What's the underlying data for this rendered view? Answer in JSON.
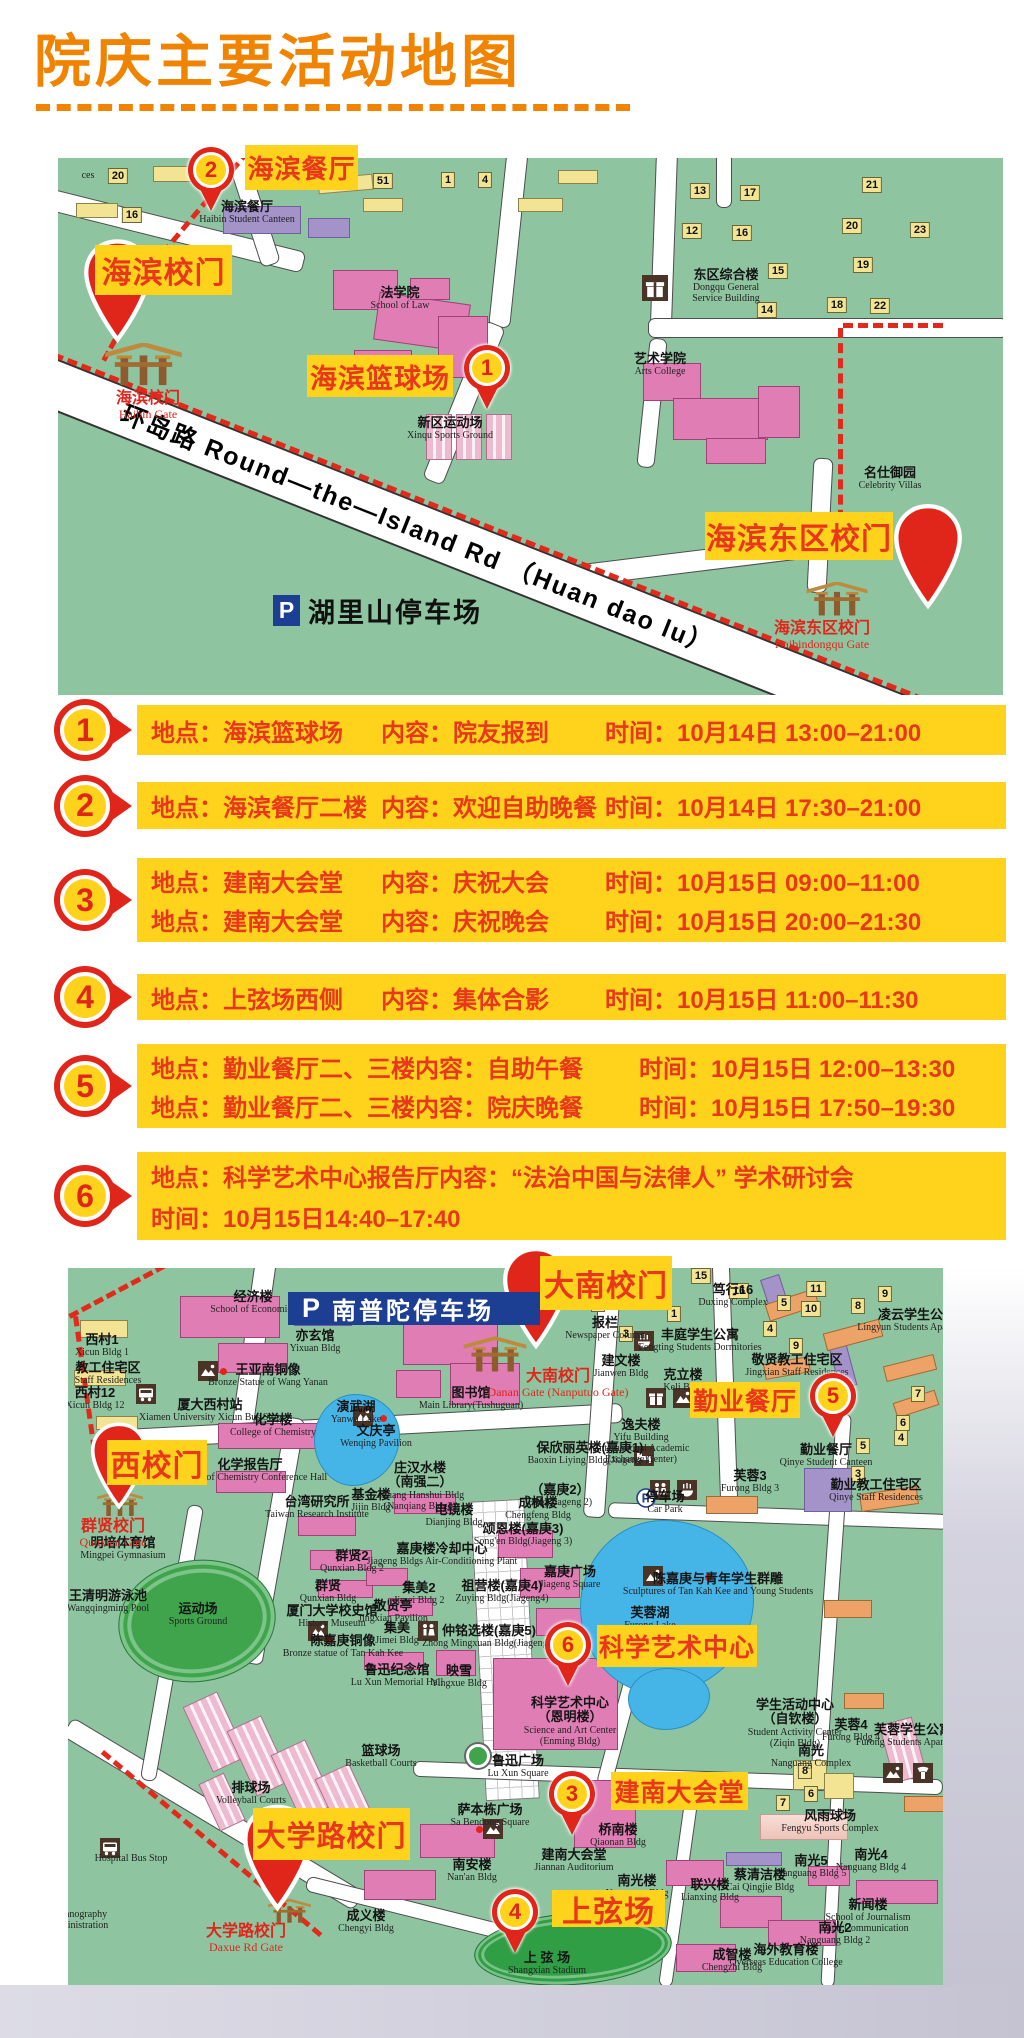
{
  "title": {
    "text": "院庆主要活动地图"
  },
  "colors": {
    "accent_orange": "#f08300",
    "tag_yellow": "#ffd31c",
    "text_red": "#e8371a",
    "pin_red": "#e0251b",
    "map_green": "#8ec5a0",
    "banner_blue": "#1c3f94",
    "lake_blue": "#45b5e8"
  },
  "top_map": {
    "road_label": "环岛路 Round—the—Island Rd （Huan dao lu）",
    "parking": {
      "p": "P",
      "text": "湖里山停车场",
      "x": 215,
      "y": 433
    },
    "tags": [
      [
        "海滨餐厅",
        187,
        -13,
        113,
        45
      ],
      [
        "海滨校门",
        37,
        87,
        137,
        50
      ],
      [
        "海滨篮球场",
        249,
        197,
        146,
        42
      ],
      [
        "海滨东区校门",
        647,
        354,
        188,
        48
      ]
    ],
    "markers": [
      [
        "2",
        153,
        12
      ],
      [
        "1",
        429,
        210
      ]
    ],
    "bigpins": [
      [
        25,
        74,
        69,
        118
      ],
      [
        835,
        335,
        70,
        127
      ]
    ],
    "gates": [
      {
        "ix": 44,
        "iy": 185,
        "iw": 83,
        "ih": 44,
        "x": 90,
        "y": 232,
        "zh": "海滨校门",
        "en": "Haibin Gate"
      },
      {
        "ix": 743,
        "iy": 424,
        "iw": 72,
        "ih": 35,
        "x": 764,
        "y": 462,
        "zh": "海滨东区校门",
        "en": "Haibindongqu Gate"
      }
    ],
    "labels": [
      [
        189,
        42,
        "海滨餐厅",
        "Haibin Student Canteen",
        ""
      ],
      [
        342,
        128,
        "法学院",
        "School of Law",
        ""
      ],
      [
        392,
        258,
        "新区运动场",
        "Xinqu Sports Ground",
        ""
      ],
      [
        602,
        194,
        "艺术学院",
        "Arts College",
        ""
      ],
      [
        668,
        110,
        "东区综合楼",
        "Dongqu General|Service Building",
        ""
      ],
      [
        832,
        308,
        "名仕御园",
        "Celebrity Villas",
        ""
      ],
      [
        30,
        12,
        "",
        "ces",
        ""
      ]
    ],
    "chips": [
      [
        "20",
        60,
        10
      ],
      [
        "16",
        74,
        49
      ],
      [
        "51",
        325,
        15
      ],
      [
        "1",
        390,
        14
      ],
      [
        "4",
        427,
        14
      ],
      [
        "13",
        642,
        25
      ],
      [
        "17",
        692,
        27
      ],
      [
        "21",
        814,
        19
      ],
      [
        "12",
        634,
        65
      ],
      [
        "16",
        684,
        67
      ],
      [
        "20",
        794,
        60
      ],
      [
        "23",
        862,
        64
      ],
      [
        "15",
        720,
        105
      ],
      [
        "19",
        805,
        99
      ],
      [
        "14",
        709,
        144
      ],
      [
        "18",
        779,
        139
      ],
      [
        "22",
        822,
        140
      ]
    ],
    "icons": [
      [
        "gift",
        584,
        117,
        26
      ]
    ],
    "dots": []
  },
  "events": {
    "field_labels": {
      "place": "地点",
      "content": "内容",
      "time": "时间"
    },
    "items": [
      {
        "num": "1",
        "y": 705,
        "h": 50,
        "rows": [
          {
            "p": "海滨篮球场",
            "c": "院友报到",
            "t": "10月14日 13:00–21:00"
          }
        ]
      },
      {
        "num": "2",
        "y": 782,
        "h": 47,
        "rows": [
          {
            "p": "海滨餐厅二楼",
            "c": "欢迎自助晚餐",
            "t": "10月14日 17:30–21:00"
          }
        ]
      },
      {
        "num": "3",
        "y": 858,
        "h": 84,
        "rows": [
          {
            "p": "建南大会堂",
            "c": "庆祝大会",
            "t": "10月15日 09:00–11:00"
          },
          {
            "p": "建南大会堂",
            "c": "庆祝晚会",
            "t": "10月15日 20:00–21:30"
          }
        ]
      },
      {
        "num": "4",
        "y": 974,
        "h": 46,
        "rows": [
          {
            "p": "上弦场西侧",
            "c": "集体合影",
            "t": "10月15日 11:00–11:30"
          }
        ]
      },
      {
        "num": "5",
        "y": 1044,
        "h": 84,
        "rows": [
          {
            "p": "勤业餐厅二、三楼",
            "c": "自助午餐",
            "t": "10月15日 12:00–13:30"
          },
          {
            "p": "勤业餐厅二、三楼",
            "c": "院庆晚餐",
            "t": "10月15日 17:50–19:30"
          }
        ]
      },
      {
        "num": "6",
        "y": 1152,
        "h": 88,
        "rows": [
          {
            "p": "科学艺术中心报告厅",
            "c": "“法治中国与法律人” 学术研讨会",
            "t": null
          },
          {
            "p": null,
            "c": null,
            "t": "10月15日14:40–17:40"
          }
        ]
      }
    ]
  },
  "bottom_map": {
    "banner": {
      "p": "P",
      "text": "南普陀停车场",
      "x": 220,
      "y": 24,
      "w": 252,
      "h": 33
    },
    "tags": [
      [
        "大南校门",
        472,
        -12,
        132,
        54
      ],
      [
        "西校门",
        39,
        172,
        100,
        45
      ],
      [
        "勤业餐厅",
        622,
        114,
        110,
        36
      ],
      [
        "科学艺术中心",
        529,
        357,
        160,
        42
      ],
      [
        "建南大会堂",
        543,
        504,
        137,
        38
      ],
      [
        "上弦场",
        484,
        622,
        113,
        37
      ],
      [
        "大学路校门",
        185,
        540,
        157,
        52
      ]
    ],
    "markers": [
      [
        "5",
        765,
        128
      ],
      [
        "6",
        500,
        377
      ],
      [
        "3",
        504,
        526
      ],
      [
        "4",
        447,
        644
      ]
    ],
    "bigpins": [
      [
        434,
        -25,
        68,
        110
      ],
      [
        22,
        148,
        58,
        100
      ],
      [
        174,
        529,
        71,
        122
      ]
    ],
    "gates": [
      {
        "ix": 394,
        "iy": 67,
        "iw": 66,
        "ih": 40,
        "x": 490,
        "y": 100,
        "zh": "大南校门",
        "en": "Danan Gate (Nanputuo Gate)"
      },
      {
        "ix": 28,
        "iy": 222,
        "iw": 48,
        "ih": 28,
        "x": 45,
        "y": 250,
        "zh": "群贤校门",
        "en": "Qunxian Gate"
      },
      {
        "ix": 199,
        "iy": 630,
        "iw": 45,
        "ih": 27,
        "x": 178,
        "y": 655,
        "zh": "大学路校门",
        "en": "Daxue Rd Gate"
      }
    ],
    "labels": [
      [
        185,
        22,
        "经济楼",
        "School of Economics",
        ""
      ],
      [
        247,
        61,
        "亦玄馆",
        "Yixuan Bldg",
        ""
      ],
      [
        200,
        95,
        "王亚南铜像",
        "Bronze Statue of Wang Yanan",
        ""
      ],
      [
        142,
        130,
        "厦大西村站",
        "Xiamen University Xicun Bus Stop",
        ""
      ],
      [
        205,
        145,
        "化学楼",
        "College of Chemistry",
        ""
      ],
      [
        288,
        132,
        "演武湖",
        "Yanwu Lake",
        ""
      ],
      [
        308,
        156,
        "文庆亭",
        "Wenqing Pavilion",
        ""
      ],
      [
        403,
        118,
        "图书馆",
        "Main Library(Tushuguan)",
        ""
      ],
      [
        182,
        190,
        "化学报告厅",
        "College of Chemistry Conference Hall",
        ""
      ],
      [
        352,
        193,
        "庄汉水楼|（南强二）",
        "Zhuang Hanshui Bldg|(Nanqiang Bldg2)",
        ""
      ],
      [
        249,
        227,
        "台湾研究所",
        "Taiwan Research Institute",
        ""
      ],
      [
        303,
        220,
        "基金楼",
        "Jijin Bldg",
        ""
      ],
      [
        386,
        235,
        "电镜楼",
        "Dianjing Bldg",
        ""
      ],
      [
        34,
        65,
        "西村1",
        "Xicun Bldg 1",
        ""
      ],
      [
        40,
        93,
        "教工住宅区",
        "Staff Residences",
        ""
      ],
      [
        27,
        118,
        "西村12",
        "Xicun Bldg 12",
        ""
      ],
      [
        522,
        173,
        "保欣丽英楼(嘉庚1)",
        "Baoxin Liying Bldg(Jiageng 1)",
        ""
      ],
      [
        492,
        215,
        "（嘉庚2）",
        "Bldg(Jiageng 2)",
        ""
      ],
      [
        470,
        228,
        "成枫楼",
        "Chengfeng Bldg",
        ""
      ],
      [
        455,
        254,
        "颂恩楼(嘉庚3)",
        "Song'en Bldg(Jiageng 3)",
        ""
      ],
      [
        374,
        274,
        "嘉庚楼冷却中心",
        "Jiageng Bldgs Air-Conditioning Plant",
        ""
      ],
      [
        434,
        311,
        "祖营楼(嘉庚4)",
        "Zuying Bldg(Jiageng4)",
        ""
      ],
      [
        502,
        297,
        "嘉庚广场",
        "Jiageng Square",
        ""
      ],
      [
        597,
        222,
        "停车场",
        "Car Park",
        ""
      ],
      [
        650,
        304,
        "陈嘉庚与青年学生群雕",
        "Sculptures of Tan Kah Kee and Young Students",
        ""
      ],
      [
        582,
        338,
        "芙蓉湖",
        "Furong Lake",
        ""
      ],
      [
        284,
        281,
        "群贤2",
        "Qunxian Bldg 2",
        ""
      ],
      [
        260,
        311,
        "群贤",
        "Qunxian Bldg",
        ""
      ],
      [
        264,
        336,
        "厦门大学校史馆",
        "History Museum",
        ""
      ],
      [
        325,
        331,
        "敬贤亭",
        "Jingxian Pavilion",
        ""
      ],
      [
        351,
        313,
        "集美2",
        "Jimei Bldg 2",
        ""
      ],
      [
        329,
        353,
        "集美",
        "Jimei Bldg",
        ""
      ],
      [
        421,
        356,
        "仲铭选楼(嘉庚5)",
        "Zhong Mingxuan Bldg(Jiageng5)",
        ""
      ],
      [
        275,
        366,
        "陈嘉庚铜像",
        "Bronze statue of Tan Kah Kee",
        ""
      ],
      [
        329,
        395,
        "鲁迅纪念馆",
        "Lu Xun Memorial Hall",
        ""
      ],
      [
        391,
        396,
        "映雪",
        "Yingxue Bldg",
        ""
      ],
      [
        313,
        476,
        "篮球场",
        "Basketball Courts",
        ""
      ],
      [
        502,
        428,
        "科学艺术中心|（恩明楼）",
        "Science and Art Center|(Enming Bldg)",
        ""
      ],
      [
        450,
        486,
        "鲁迅广场",
        "Lu Xun Square",
        ""
      ],
      [
        727,
        430,
        "学生活动中心|（自钦楼）",
        "Student Activity Center|(Ziqin Bldg)",
        ""
      ],
      [
        783,
        450,
        "芙蓉4",
        "Furong Bldg 4",
        ""
      ],
      [
        845,
        455,
        "芙蓉学生公寓",
        "Furong Students Apartments",
        ""
      ],
      [
        743,
        476,
        "南光",
        "Nanguang Complex",
        ""
      ],
      [
        762,
        541,
        "风雨球场",
        "Fengyu Sports Complex",
        ""
      ],
      [
        550,
        555,
        "桥南楼",
        "Qiaonan Bldg",
        ""
      ],
      [
        743,
        586,
        "南光5",
        "Nanguang Bldg 5",
        ""
      ],
      [
        803,
        580,
        "南光4",
        "Nanguang Bldg 4",
        ""
      ],
      [
        692,
        600,
        "蔡清洁楼",
        "Cai Qingjie Bldg",
        ""
      ],
      [
        642,
        610,
        "联兴楼",
        "Lianxing Bldg",
        ""
      ],
      [
        569,
        606,
        "南光楼",
        "Nanguang Bldg",
        ""
      ],
      [
        800,
        630,
        "新闻楼",
        "School of Journalism|and Communication",
        ""
      ],
      [
        767,
        653,
        "南光2",
        "Nanguang Bldg 2",
        ""
      ],
      [
        664,
        680,
        "成智楼",
        "Chengzhi Bldg",
        ""
      ],
      [
        718,
        675,
        "海外教育楼",
        "Overseas Education College",
        ""
      ],
      [
        849,
        40,
        "凌云学生公寓",
        "Lingyun Students Apartments",
        ""
      ],
      [
        729,
        85,
        "敬贤教工住宅区",
        "Jingxian Staff Residences",
        ""
      ],
      [
        632,
        60,
        "丰庭学生公寓",
        "Fengting Students Dormitories",
        ""
      ],
      [
        665,
        15,
        "笃行16",
        "Duxing Complex",
        ""
      ],
      [
        553,
        86,
        "建文楼",
        "Jianwen Bldg",
        ""
      ],
      [
        615,
        100,
        "克立楼",
        "Keli Bldg",
        ""
      ],
      [
        537,
        48,
        "报栏",
        "Newspaper Column",
        ""
      ],
      [
        573,
        150,
        "逸夫楼",
        "Yifu Building|(International Academic|Exchange Center)",
        ""
      ],
      [
        758,
        175,
        "勤业餐厅",
        "Qinye Student Canteen",
        ""
      ],
      [
        808,
        210,
        "勤业教工住宅区",
        "Qinye Staff Residences",
        ""
      ],
      [
        682,
        201,
        "芙蓉3",
        "Furong Bldg 3",
        ""
      ],
      [
        404,
        590,
        "南安楼",
        "Nan'an Bldg",
        ""
      ],
      [
        298,
        641,
        "成义楼",
        "Chengyi Bldg",
        ""
      ],
      [
        422,
        535,
        "萨本栋广场",
        "Sa Bendong Square",
        ""
      ],
      [
        506,
        580,
        "建南大会堂",
        "Jiannan Auditorium",
        ""
      ],
      [
        479,
        683,
        "上 弦 场",
        "Shangxian Stadium",
        ""
      ],
      [
        183,
        513,
        "排球场",
        "Volleyball Courts",
        ""
      ],
      [
        63,
        585,
        "",
        "Hospital Bus Stop",
        ""
      ],
      [
        10,
        641,
        "",
        "Oceanography|Administration",
        ""
      ],
      [
        55,
        268,
        "明培体育馆",
        "Mingpei Gymnasium",
        ""
      ],
      [
        40,
        321,
        "王清明游泳池",
        "Wangqingming Pool",
        ""
      ],
      [
        130,
        334,
        "运动场",
        "Sports Ground",
        ""
      ]
    ],
    "chips": [
      [
        "15",
        633,
        0
      ],
      [
        "16",
        671,
        15
      ],
      [
        "11",
        748,
        13
      ],
      [
        "10",
        743,
        33
      ],
      [
        "5",
        716,
        27
      ],
      [
        "8",
        790,
        30
      ],
      [
        "9",
        817,
        18
      ],
      [
        "4",
        702,
        53
      ],
      [
        "9",
        728,
        70
      ],
      [
        "7",
        850,
        118
      ],
      [
        "6",
        835,
        147
      ],
      [
        "4",
        833,
        162
      ],
      [
        "5",
        795,
        170
      ],
      [
        "3",
        790,
        198
      ],
      [
        "1",
        606,
        38
      ],
      [
        "2",
        530,
        28
      ],
      [
        "3",
        558,
        58
      ],
      [
        "8",
        737,
        495
      ],
      [
        "6",
        743,
        518
      ],
      [
        "7",
        715,
        527
      ]
    ],
    "icons": [
      [
        "photo",
        130,
        93
      ],
      [
        "bus",
        68,
        116
      ],
      [
        "photo",
        285,
        138
      ],
      [
        "photo",
        575,
        298
      ],
      [
        "photo",
        240,
        353
      ],
      [
        "photo",
        415,
        551
      ],
      [
        "gift",
        578,
        120
      ],
      [
        "photo",
        605,
        120
      ],
      [
        "bed",
        566,
        178
      ],
      [
        "wc",
        582,
        212
      ],
      [
        "bowl",
        609,
        212
      ],
      [
        "wc",
        350,
        353
      ],
      [
        "bowl",
        566,
        63
      ],
      [
        "pc",
        568,
        220
      ],
      [
        "bus",
        32,
        570
      ],
      [
        "phone",
        845,
        495
      ],
      [
        "photo",
        815,
        495
      ]
    ],
    "dots": [
      [
        152,
        100
      ],
      [
        312,
        147
      ],
      [
        637,
        306
      ],
      [
        258,
        368
      ],
      [
        408,
        558
      ]
    ]
  }
}
